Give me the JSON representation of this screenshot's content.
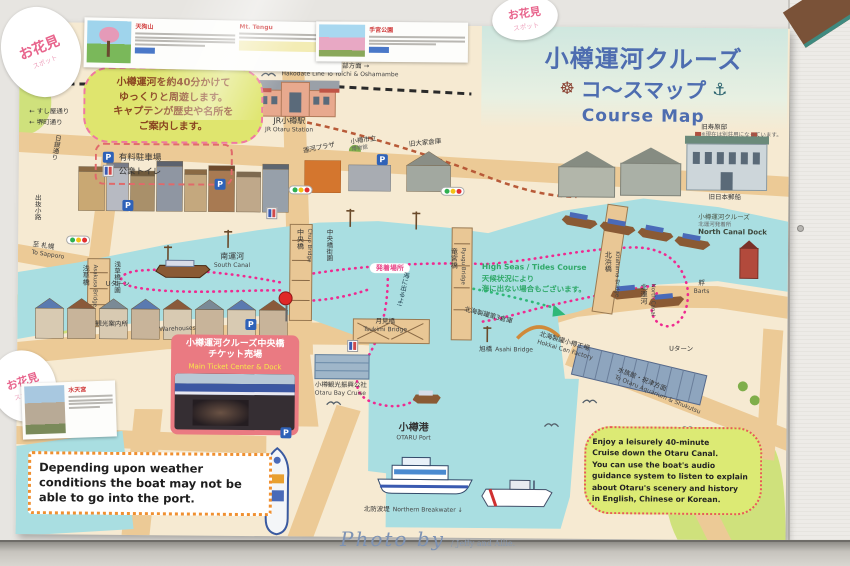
{
  "stickers": {
    "hanami": "お花見",
    "spot": "スポット"
  },
  "cards": {
    "a": {
      "title_jp": "天狗山",
      "title_en": "Mt. Tengu"
    },
    "b": {
      "title": "手宮公園"
    },
    "c": {
      "title": "水天宮"
    }
  },
  "watermark": {
    "main": "Photo by",
    "sub": "/ Jeffy and Allie."
  },
  "poster": {
    "title": {
      "line1": "小樽運河クルーズ",
      "line2": "コ〜スマップ",
      "en": "Course Map"
    },
    "icons": {
      "wheel": "☸",
      "anchor": "⚓",
      "parking_glyph": "P"
    },
    "intro_bubble": {
      "lines": [
        "小樽運河を約40分かけて",
        "ゆっくりと周遊します。",
        "キャプテンが歴史や名所を",
        "ご案内します。"
      ]
    },
    "legend": {
      "parking": "有料駐車場",
      "toilet": "公衆トイレ"
    },
    "ticket_box": {
      "line1": "小樽運河クルーズ中央橋",
      "line2": "チケット売場",
      "en": "Main Ticket Center & Dock"
    },
    "weather_notice": "Depending upon weather conditions the boat may not be able to go into the port.",
    "info_bubble": {
      "lines": [
        "Enjoy a leisurely 40-minute",
        "Cruise down the Otaru Canal.",
        "You can use the boat's audio",
        "guidance system to listen to explain",
        "about Otaru's scenery and history",
        "in English, Chinese or Korean."
      ]
    },
    "labels": [
      {
        "id": "label-rail-line",
        "jp": "函館本線  余市・長万部方面 →",
        "en": "Hakodate Line To Yoichi & Oshamambe",
        "x": 262,
        "y": 38,
        "cls": "tiny"
      },
      {
        "id": "label-jr-station",
        "jp": "JR小樽駅",
        "en": "JR Otaru Station",
        "x": 246,
        "y": 92,
        "cls": "center"
      },
      {
        "id": "label-to-sapporo-rail",
        "jp": "至 札幌方面",
        "en": "To Sappro",
        "x": 12,
        "y": 38,
        "cls": "tiny"
      },
      {
        "id": "label-sushiya-st",
        "jp": "← すし屋通り",
        "x": 10,
        "y": 86,
        "cls": "tiny"
      },
      {
        "id": "label-sakaimachi-st",
        "jp": "← 堺町通り",
        "x": 10,
        "y": 97,
        "cls": "tiny"
      },
      {
        "id": "label-nichigin-st",
        "jp": "日銀通り",
        "x": 32,
        "y": 112,
        "cls": "tiny vert",
        "rot": 10
      },
      {
        "id": "label-denuki-koji",
        "jp": "出抜小路",
        "x": 14,
        "y": 172,
        "cls": "tiny vert"
      },
      {
        "id": "label-to-sapporo-road",
        "jp": "至 札幌",
        "en": "To Sapporo",
        "x": 14,
        "y": 221,
        "cls": "tiny",
        "rot": 8
      },
      {
        "id": "label-asakusa-bridge",
        "jp": "浅草橋",
        "en": "Asakusa Bridge",
        "x": 64,
        "y": 242,
        "cls": "vpair"
      },
      {
        "id": "label-asakusabashi-gaien",
        "jp": "浅草橋街園",
        "x": 94,
        "y": 238,
        "cls": "tiny vert"
      },
      {
        "id": "label-tourist-info",
        "jp": "観光案内所",
        "x": 78,
        "y": 298,
        "cls": "tiny"
      },
      {
        "id": "label-south-canal",
        "jp": "南運河",
        "en": "South Canal",
        "x": 196,
        "y": 228,
        "cls": "center"
      },
      {
        "id": "label-boarding",
        "jp": "発着場所",
        "x": 352,
        "y": 238,
        "cls": "oval"
      },
      {
        "id": "label-uturn-south",
        "jp": "Uターン",
        "x": 88,
        "y": 258,
        "cls": "tiny"
      },
      {
        "id": "label-warehouses",
        "en": "Warehouses",
        "x": 142,
        "y": 302,
        "cls": "tiny",
        "rot": -3
      },
      {
        "id": "label-chuo-bridge",
        "jp": "中央橋",
        "en": "Chuo Bridge",
        "x": 278,
        "y": 204,
        "cls": "vpair"
      },
      {
        "id": "label-chuobashi-gaien",
        "jp": "中央橋街園",
        "x": 306,
        "y": 204,
        "cls": "tiny vert"
      },
      {
        "id": "label-canal-plaza",
        "jp": "運河プラザ",
        "x": 284,
        "y": 120,
        "cls": "tiny",
        "rot": -12
      },
      {
        "id": "label-city-museum",
        "jp": "小樽市立",
        "sub": "博物館",
        "x": 332,
        "y": 112,
        "cls": "tiny",
        "rot": -8
      },
      {
        "id": "label-ooie-warehouse",
        "jp": "旧大家倉庫",
        "x": 390,
        "y": 114,
        "cls": "tiny",
        "rot": -6
      },
      {
        "id": "label-ryugu-bridge",
        "jp": "竜宮橋",
        "en": "Ryugu Bridge",
        "x": 432,
        "y": 222,
        "cls": "vpair"
      },
      {
        "id": "label-tsukimi-bridge",
        "jp": "月見橋",
        "en": "Tsukimi Bridge",
        "x": 346,
        "y": 293,
        "cls": "tiny center"
      },
      {
        "id": "label-out-to-sea",
        "jp": "海に出るよ!",
        "x": 380,
        "y": 246,
        "cls": "tiny vert ink",
        "rot": 12
      },
      {
        "id": "label-tides-course",
        "en": "High Seas / Tides Course",
        "x": 464,
        "y": 236,
        "cls": "green-note"
      },
      {
        "id": "label-tides-note1",
        "jp": "天候状況により",
        "x": 464,
        "y": 248,
        "cls": "green-note"
      },
      {
        "id": "label-tides-note2",
        "jp": "海に出ない場合もございます。",
        "x": 464,
        "y": 258,
        "cls": "green-note"
      },
      {
        "id": "label-kitahama-bridge",
        "jp": "北浜橋",
        "en": "Kitahama Bridge",
        "x": 586,
        "y": 224,
        "cls": "vpair"
      },
      {
        "id": "label-north-canal",
        "jp": "北運河",
        "en": "North Canal",
        "x": 622,
        "y": 256,
        "cls": "vpair"
      },
      {
        "id": "label-barge",
        "jp": "艀",
        "en": "Barts",
        "x": 676,
        "y": 252,
        "cls": "tiny center"
      },
      {
        "id": "label-suhara-tei",
        "jp": "旧寿原邸",
        "sub": "※現在は別荘用になっています。",
        "x": 682,
        "y": 96,
        "cls": "tiny"
      },
      {
        "id": "label-nippon-yusen",
        "jp": "旧日本郵船",
        "x": 690,
        "y": 166,
        "cls": "tiny"
      },
      {
        "id": "label-north-dock",
        "jp": "小樽運河クルーズ",
        "sub": "北運河発着所",
        "en": "North Canal Dock",
        "x": 680,
        "y": 186,
        "cls": "tiny dock"
      },
      {
        "id": "label-uturn-north",
        "jp": "Uターン",
        "x": 652,
        "y": 318,
        "cls": "tiny"
      },
      {
        "id": "label-hokkai-can-warehouse",
        "jp": "北海製罐第3倉庫",
        "x": 446,
        "y": 286,
        "cls": "tiny",
        "rot": 14
      },
      {
        "id": "label-asahi-bridge",
        "jp": "旭橋",
        "en": "Asahi Bridge",
        "x": 462,
        "y": 320,
        "cls": "tiny inline"
      },
      {
        "id": "label-hokkai-can-factory",
        "jp": "北海製罐小樽工場",
        "en": "Hokkai Can Factory",
        "x": 520,
        "y": 312,
        "cls": "tiny",
        "rot": 16
      },
      {
        "id": "label-to-aquarium",
        "jp": "水族館・祝津方面",
        "en": "To Otaru Aquarium & Shukutsu",
        "x": 596,
        "y": 356,
        "cls": "tiny",
        "rot": 22
      },
      {
        "id": "label-bay-cruise",
        "jp": "小樽観光振興公社",
        "en": "Otaru Bay Cruise",
        "x": 298,
        "y": 357,
        "cls": "tiny"
      },
      {
        "id": "label-otaru-port",
        "jp": "小樽港",
        "en": "OTARU Port",
        "x": 380,
        "y": 397,
        "cls": "center port"
      },
      {
        "id": "label-breakwater",
        "jp": "北防波堤",
        "en": "Northern Breakwater ↓",
        "x": 348,
        "y": 481,
        "cls": "tiny inline"
      }
    ],
    "markers": [
      {
        "type": "parking",
        "x": 196,
        "y": 155
      },
      {
        "type": "parking",
        "x": 104,
        "y": 177
      },
      {
        "type": "parking",
        "x": 358,
        "y": 129
      },
      {
        "type": "parking",
        "x": 228,
        "y": 295
      },
      {
        "type": "parking",
        "x": 264,
        "y": 403
      },
      {
        "type": "toilet",
        "x": 248,
        "y": 183
      },
      {
        "type": "toilet",
        "x": 330,
        "y": 315
      },
      {
        "type": "traffic",
        "x": 48,
        "y": 213
      },
      {
        "type": "traffic",
        "x": 270,
        "y": 161
      },
      {
        "type": "traffic",
        "x": 422,
        "y": 161
      },
      {
        "type": "signal",
        "x": 261,
        "y": 267
      }
    ],
    "colors": {
      "water": "#a9dee1",
      "road": "#ecca96",
      "park": "#cfe17c",
      "route_pink": "#ef2a90",
      "route_green": "#2fb878",
      "title_blue": "#4e6db0"
    }
  }
}
